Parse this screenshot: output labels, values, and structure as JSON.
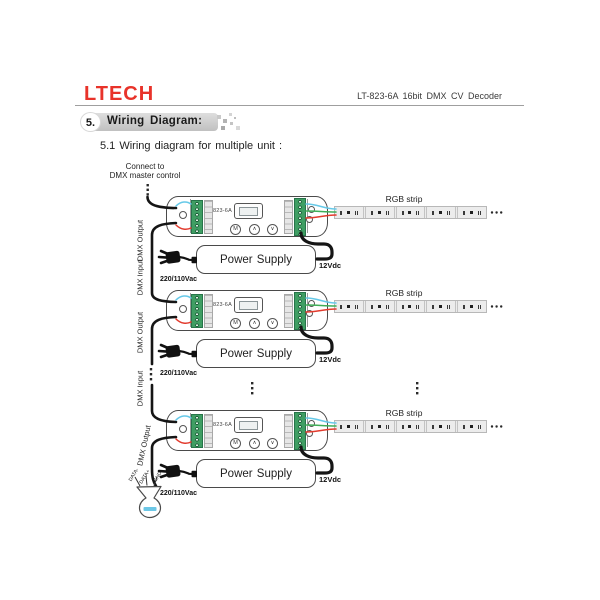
{
  "header": {
    "logo": "LTECH",
    "product_title": "LT-823-6A 16bit DMX CV Decoder"
  },
  "section": {
    "number": "5.",
    "title": "Wiring Diagram:"
  },
  "subtitle": "5.1 Wiring diagram for multiple unit :",
  "diagram": {
    "master_control_label": {
      "line1": "Connect to",
      "line2": "DMX master control"
    },
    "dmx_chain_labels": [
      "DMX Output",
      "DMX Input",
      "DMX Output",
      "DMX Input",
      "DMX Output"
    ],
    "units": [
      {
        "model": "823-6A",
        "button_m": "M",
        "button_up": "∧",
        "button_down": "∨",
        "rgb_strip_label": "RGB strip",
        "power_supply_label": "Power Supply",
        "input_voltage": "220/110Vac",
        "output_voltage": "12Vdc"
      },
      {
        "model": "823-6A",
        "button_m": "M",
        "button_up": "∧",
        "button_down": "∨",
        "rgb_strip_label": "RGB strip",
        "power_supply_label": "Power Supply",
        "input_voltage": "220/110Vac",
        "output_voltage": "12Vdc"
      },
      {
        "model": "823-6A",
        "button_m": "M",
        "button_up": "∧",
        "button_down": "∨",
        "rgb_strip_label": "RGB strip",
        "power_supply_label": "Power Supply",
        "input_voltage": "220/110Vac",
        "output_voltage": "12Vdc"
      }
    ],
    "cable_end_labels": [
      "DATA-",
      "DATA+",
      "GND"
    ],
    "colors": {
      "logo_red": "#e8332a",
      "terminal_green": "#3f9e63",
      "wire_cyan": "#66c9e8",
      "wire_green": "#3fae58",
      "wire_red": "#e23b2e",
      "wire_black": "#151515"
    }
  }
}
